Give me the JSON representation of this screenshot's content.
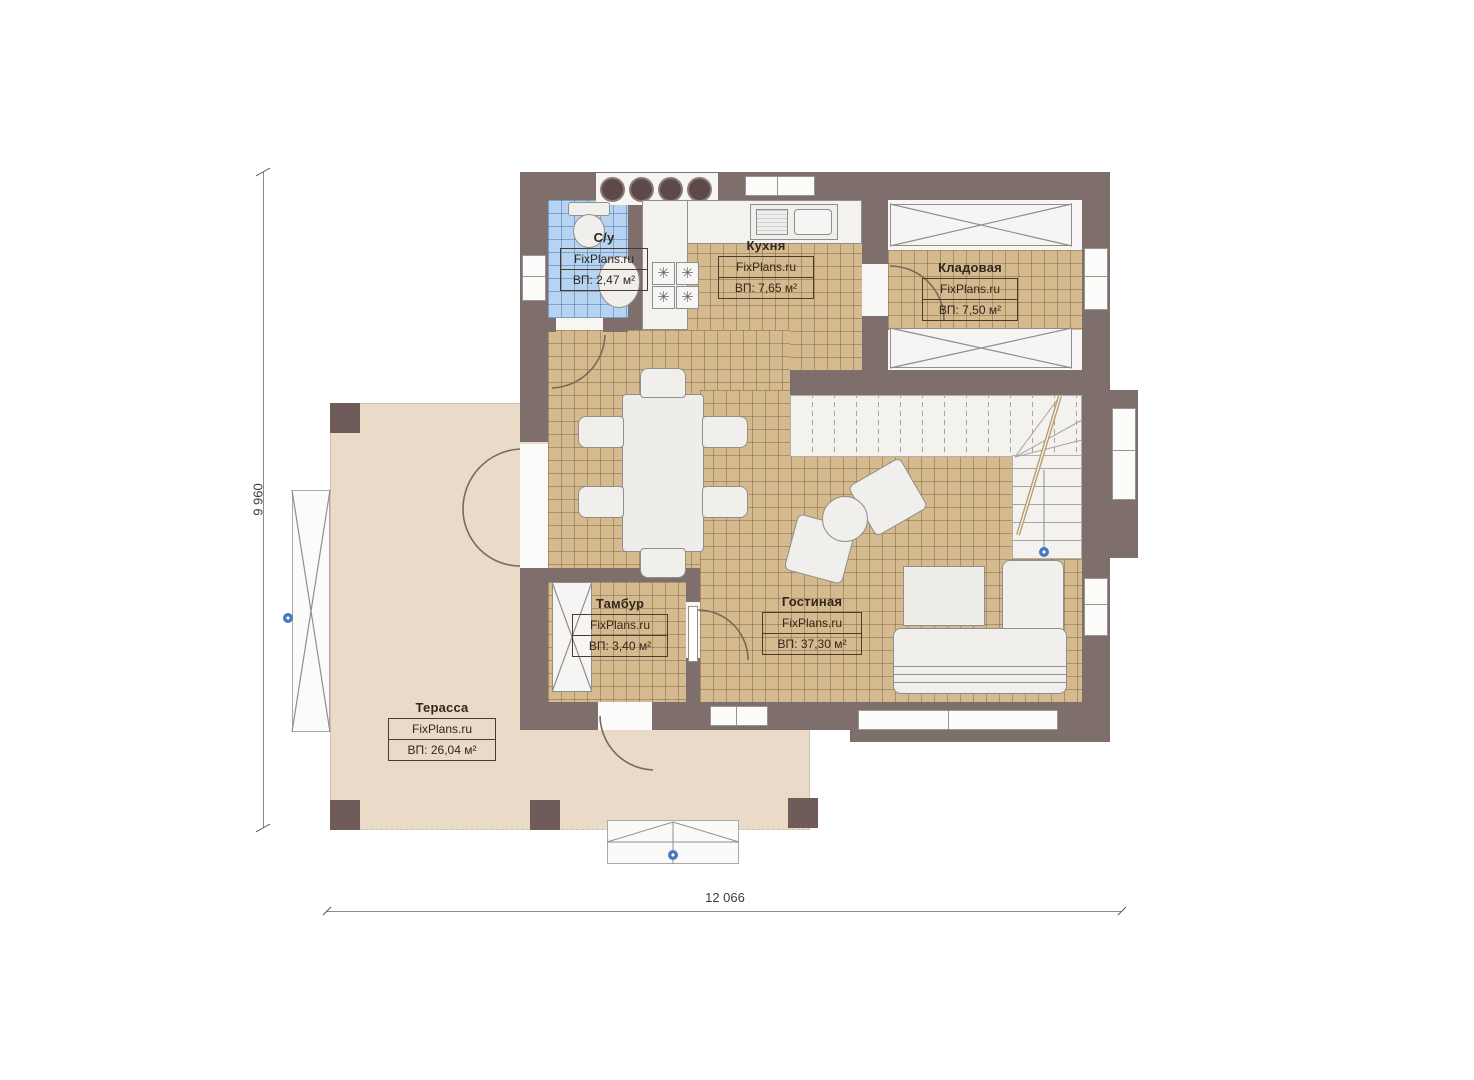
{
  "plan": {
    "title": "house-first-floor-plan",
    "brand": "FixPlans.ru",
    "dimensions": {
      "height_label": "9 960",
      "width_label": "12 066"
    },
    "rooms": [
      {
        "id": "bathroom",
        "name": "С/у",
        "brand": "FixPlans.ru",
        "area": "ВП: 2,47 м²"
      },
      {
        "id": "kitchen",
        "name": "Кухня",
        "brand": "FixPlans.ru",
        "area": "ВП: 7,65 м²"
      },
      {
        "id": "storage",
        "name": "Кладовая",
        "brand": "FixPlans.ru",
        "area": "ВП: 7,50 м²"
      },
      {
        "id": "tambour",
        "name": "Тамбур",
        "brand": "FixPlans.ru",
        "area": "ВП: 3,40 м²"
      },
      {
        "id": "living",
        "name": "Гостиная",
        "brand": "FixPlans.ru",
        "area": "ВП: 37,30 м²"
      },
      {
        "id": "terrace",
        "name": "Терасса",
        "brand": "FixPlans.ru",
        "area": "ВП: 26,04 м²"
      }
    ],
    "icons": {
      "hob_burner": "✳"
    },
    "colors": {
      "wall": "#7e6e6c",
      "floor_tile": "#d4ba8e",
      "terrace": "#e9dbc8",
      "bathroom_tile": "#b6d3f1",
      "marker_blue": "#4878c0"
    }
  }
}
